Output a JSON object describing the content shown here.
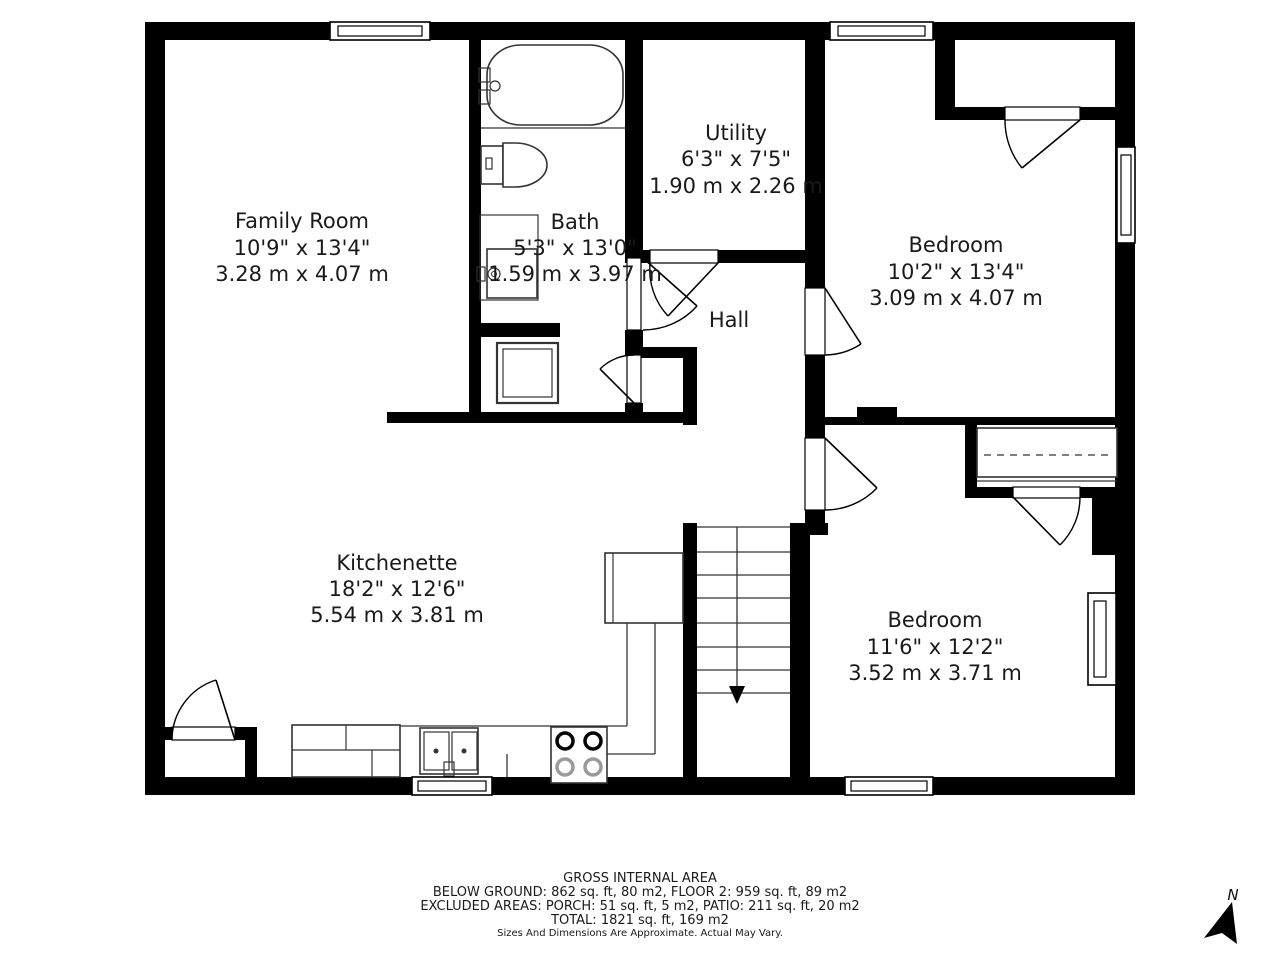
{
  "rooms": [
    {
      "id": "family-room",
      "name": "Family Room",
      "dim_ft": "10'9\" x 13'4\"",
      "dim_m": "3.28 m x 4.07 m"
    },
    {
      "id": "bath",
      "name": "Bath",
      "dim_ft": "5'3\" x 13'0\"",
      "dim_m": "1.59 m x 3.97 m"
    },
    {
      "id": "utility",
      "name": "Utility",
      "dim_ft": "6'3\" x 7'5\"",
      "dim_m": "1.90 m x 2.26 m"
    },
    {
      "id": "bedroom-1",
      "name": "Bedroom",
      "dim_ft": "10'2\" x 13'4\"",
      "dim_m": "3.09 m x 4.07 m"
    },
    {
      "id": "hall",
      "name": "Hall",
      "dim_ft": "",
      "dim_m": ""
    },
    {
      "id": "kitchenette",
      "name": "Kitchenette",
      "dim_ft": "18'2\" x 12'6\"",
      "dim_m": "5.54 m x 3.81 m"
    },
    {
      "id": "bedroom-2",
      "name": "Bedroom",
      "dim_ft": "11'6\" x 12'2\"",
      "dim_m": "3.52 m x 3.71 m"
    }
  ],
  "footer": {
    "title": "GROSS INTERNAL AREA",
    "line1": "BELOW GROUND: 862 sq. ft, 80 m2, FLOOR 2: 959 sq. ft, 89 m2",
    "line2": "EXCLUDED AREAS: PORCH: 51 sq. ft, 5 m2, PATIO: 211 sq. ft, 20 m2",
    "line3": "TOTAL: 1821 sq. ft, 169 m2",
    "disclaimer": "Sizes And Dimensions Are Approximate. Actual May Vary."
  },
  "compass": {
    "label": "N"
  },
  "colors": {
    "wall": "#000000",
    "background": "#ffffff",
    "text": "#1a1a1a"
  }
}
